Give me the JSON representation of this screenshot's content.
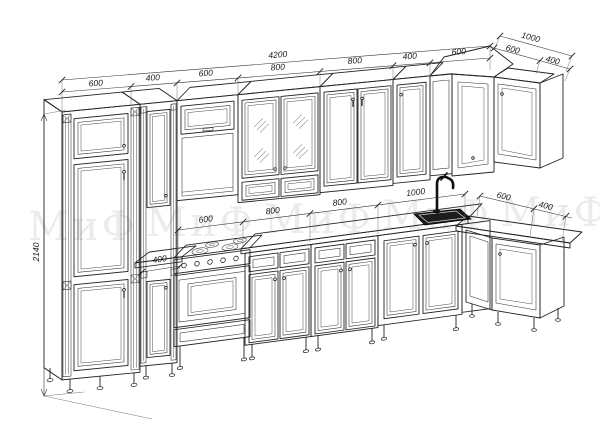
{
  "watermark": {
    "text": "МиФ"
  },
  "dims": {
    "overall_width": "4200",
    "top_chain": [
      "600",
      "400",
      "600",
      "800",
      "800",
      "400",
      "600"
    ],
    "return_overall": "1000",
    "return_chain": [
      "600",
      "400"
    ],
    "mid_chain": [
      "600",
      "800",
      "800",
      "1000"
    ],
    "mid_return_chain": [
      "600",
      "400"
    ],
    "base_unit": "400",
    "height": "2140"
  },
  "style": {
    "line_color": "#232323",
    "dim_text_color": "#1a1a1a",
    "watermark_color": "#ebebeb",
    "background": "#ffffff"
  }
}
